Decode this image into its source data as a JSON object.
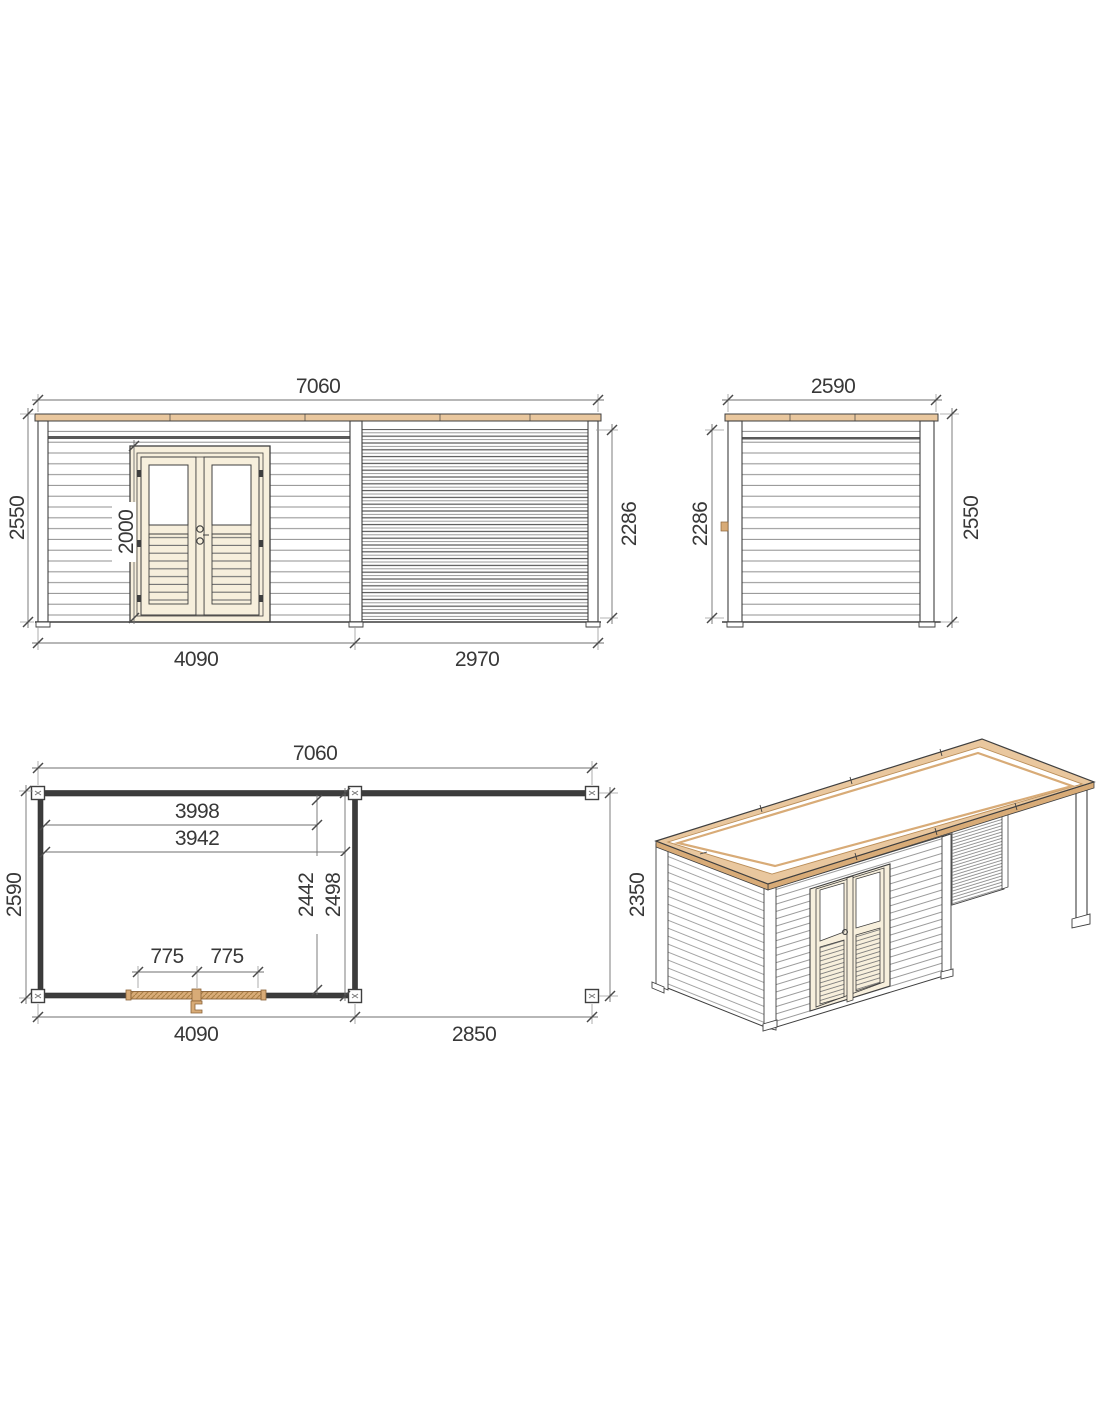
{
  "drawing": {
    "front": {
      "total_width": "7060",
      "overall_height": "2550",
      "door_height": "2000",
      "room_width": "4090",
      "annex_width": "2970",
      "wall_height": "2286"
    },
    "side": {
      "width": "2590",
      "wall_height": "2286",
      "overall_height": "2550"
    },
    "plan": {
      "total_width": "7060",
      "inner_width_a": "3998",
      "inner_width_b": "3942",
      "depth": "2590",
      "inner_depth_a": "2442",
      "inner_depth_b": "2498",
      "door_leaf_left": "775",
      "door_leaf_right": "775",
      "room_width": "4090",
      "canopy_width": "2850",
      "canopy_depth": "2350"
    }
  },
  "colors": {
    "background": "#ffffff",
    "wood_light": "#e9c79e",
    "wood_mid": "#d8ab77",
    "wood_hatch": "#a97f46",
    "door_cream": "#f7efdc",
    "line_dark": "#3f3f3f",
    "line_dim": "#6f6f6f",
    "line_siding": "#9b9b9b",
    "text": "#383838"
  }
}
